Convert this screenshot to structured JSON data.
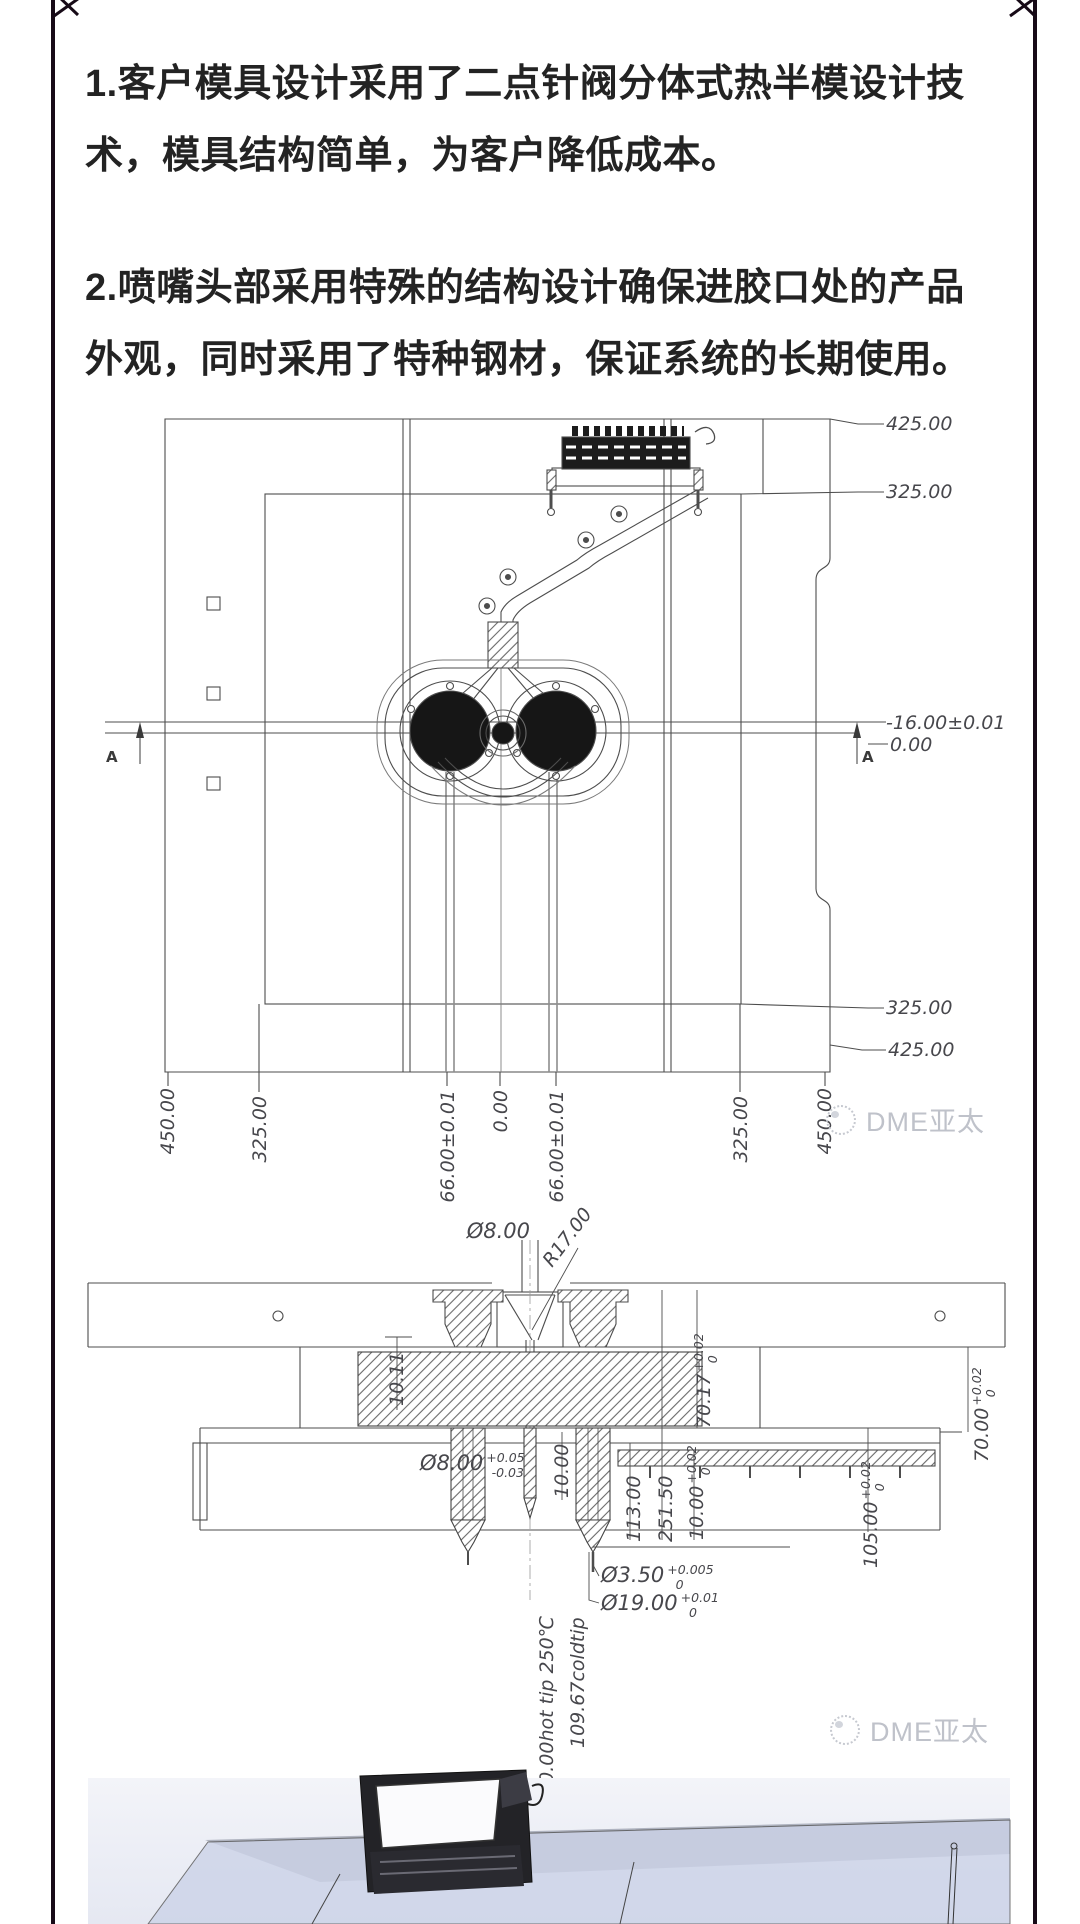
{
  "page": {
    "background": "#ffffff",
    "frame_color": "#170a17"
  },
  "paragraphs": [
    {
      "text": "1.客户模具设计采用了二点针阀分体式热半模设计技术，模具结构简单，为客户降低成本。"
    },
    {
      "text": "2.喷嘴头部采用特殊的结构设计确保进胶口处的产品外观，同时采用了特种钢材，保证系统的长期使用。"
    }
  ],
  "watermark": {
    "icon": "dme-logo-icon",
    "text": "DME亚太"
  },
  "drawing1": {
    "title": "two-drop valve-gate hot half — plan view",
    "section_label": "A",
    "dims_right": [
      "425.00",
      "325.00",
      "-16.00±0.01",
      "0.00",
      "325.00",
      "425.00"
    ],
    "dims_bottom": [
      "450.00",
      "325.00",
      "66.00±0.01",
      "0.00",
      "66.00±0.01",
      "325.00",
      "450.00"
    ]
  },
  "drawing2": {
    "title": "nozzle cross-section view",
    "d8": "Ø8.00",
    "r17": "R17.00",
    "d1011": "10.11",
    "t7017": {
      "v": "70.17",
      "up": "+0.02",
      "dn": "0"
    },
    "t7000": {
      "v": "70.00",
      "up": "+0.02",
      "dn": "0"
    },
    "d8tol": {
      "v": "Ø8.00",
      "up": "+0.05",
      "dn": "-0.03"
    },
    "d10a": "10.00",
    "d113": "113.00",
    "d25150": "251.50",
    "t10b": {
      "v": "10.00",
      "up": "+0.02",
      "dn": "0"
    },
    "t105": {
      "v": "105.00",
      "up": "+0.02",
      "dn": "0"
    },
    "t350": {
      "v": "Ø3.50",
      "up": "+0.005",
      "dn": "0"
    },
    "t1900": {
      "v": "Ø19.00",
      "up": "+0.01",
      "dn": "0"
    },
    "hot": "110.00hot tip 250℃",
    "cold": "109.67coldtip"
  }
}
